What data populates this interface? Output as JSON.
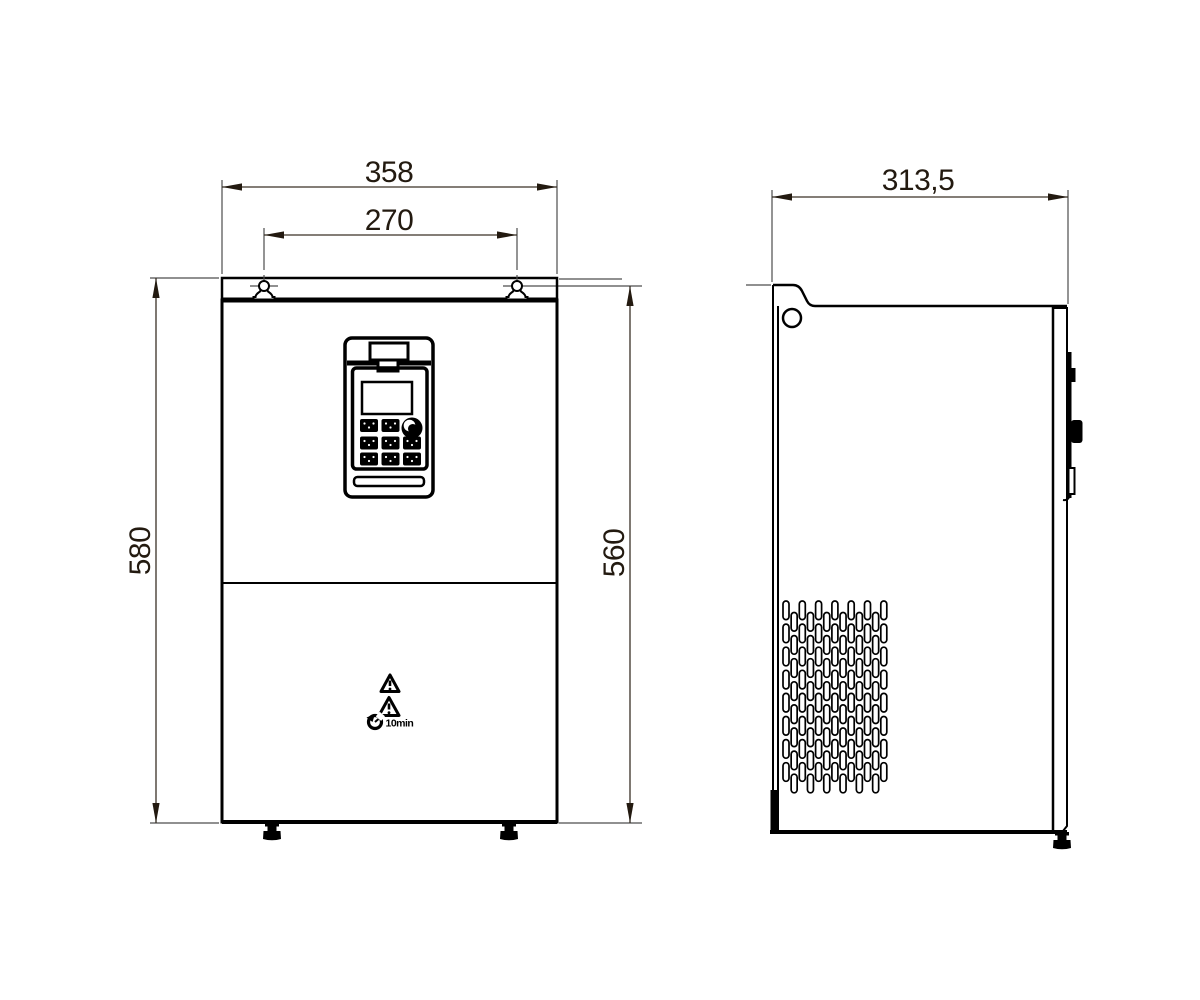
{
  "front_view": {
    "dimensions": {
      "overall_width": "358",
      "mounting_hole_spacing": "270",
      "overall_height": "580",
      "body_height": "560"
    },
    "warning": {
      "wait_time_label": "10min"
    }
  },
  "side_view": {
    "dimensions": {
      "overall_depth": "313,5"
    }
  },
  "icons": {
    "warning": "triangle-exclamation-icon",
    "wait": "clock-discharge-icon",
    "keypad_knob": "rotary-knob-icon"
  },
  "colors": {
    "object_line": "#000000",
    "dimension_line": "#4d4d4d",
    "dimension_text": "#231a10",
    "background": "#ffffff"
  }
}
